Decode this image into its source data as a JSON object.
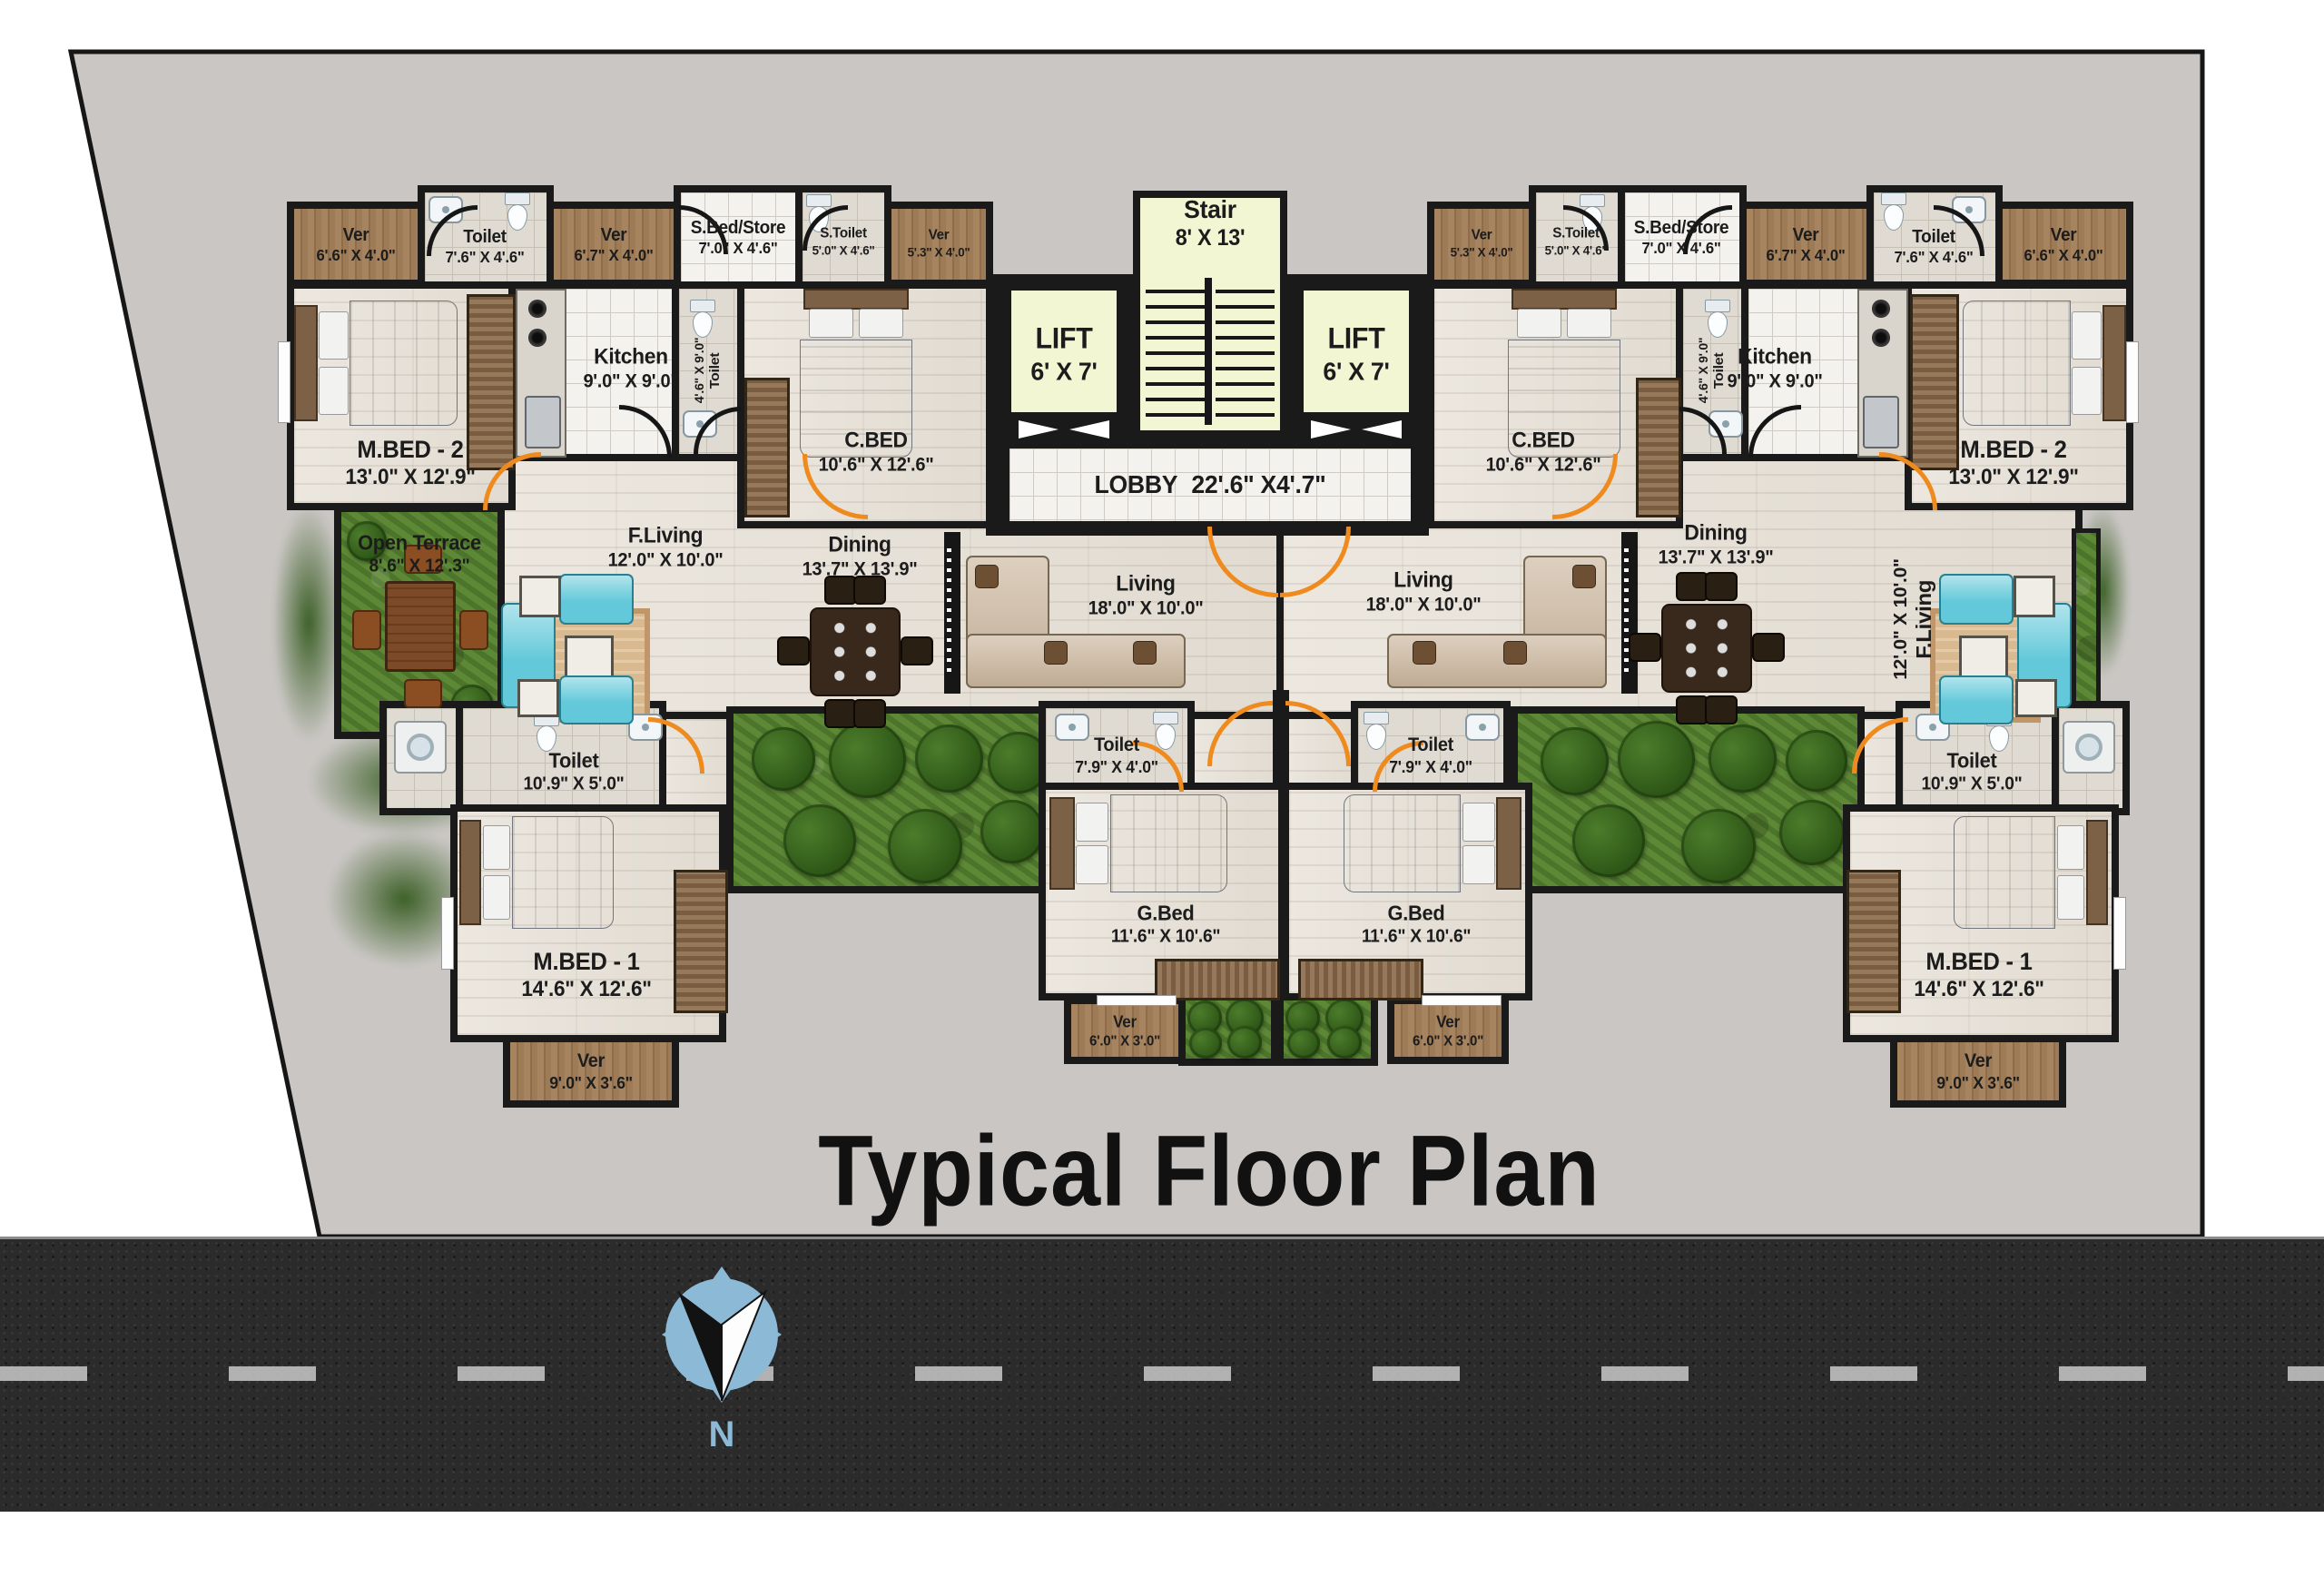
{
  "title": "Typical Floor Plan",
  "compass": {
    "label": "N"
  },
  "core": {
    "stair": {
      "label": "Stair",
      "dims": "8' X 13'"
    },
    "lift_left": {
      "label": "LIFT",
      "dims": "6' X 7'"
    },
    "lift_right": {
      "label": "LIFT",
      "dims": "6' X 7'"
    },
    "lobby": {
      "label": "LOBBY",
      "dims": "22'.6\" X4'.7\""
    }
  },
  "left_unit": {
    "ver_top_1": {
      "label": "Ver",
      "dims": "6'.6\" X 4'.0\""
    },
    "toilet_top": {
      "label": "Toilet",
      "dims": "7'.6\" X 4'.6\""
    },
    "ver_top_2": {
      "label": "Ver",
      "dims": "6'.7\" X 4'.0\""
    },
    "sbed_store": {
      "label": "S.Bed/Store",
      "dims": "7'.0\" X 4'.6\""
    },
    "s_toilet": {
      "label": "S.Toilet",
      "dims": "5'.0\" X 4'.6\""
    },
    "ver_top_3": {
      "label": "Ver",
      "dims": "5'.3\" X 4'.0\""
    },
    "mbed2": {
      "label": "M.BED - 2",
      "dims": "13'.0\" X 12'.9\""
    },
    "kitchen": {
      "label": "Kitchen",
      "dims": "9'.0\" X 9'.0\""
    },
    "toilet_kitchen": {
      "label": "Toilet",
      "dims": "4'.6\" X 9'.0\""
    },
    "cbed": {
      "label": "C.BED",
      "dims": "10'.6\" X 12'.6\""
    },
    "open_terrace": {
      "label": "Open Terrace",
      "dims": "8'.6\" X 12'.3\""
    },
    "f_living": {
      "label": "F.Living",
      "dims": "12'.0\" X 10'.0\""
    },
    "dining": {
      "label": "Dining",
      "dims": "13'.7\" X 13'.9\""
    },
    "living": {
      "label": "Living",
      "dims": "18'.0\" X 10'.0\""
    },
    "toilet_mid": {
      "label": "Toilet",
      "dims": "7'.9\" X 4'.0\""
    },
    "toilet_low": {
      "label": "Toilet",
      "dims": "10'.9\" X 5'.0\""
    },
    "gbed": {
      "label": "G.Bed",
      "dims": "11'.6\" X 10'.6\""
    },
    "ver_small": {
      "label": "Ver",
      "dims": "6'.0\" X 3'.0\""
    },
    "mbed1": {
      "label": "M.BED - 1",
      "dims": "14'.6\" X 12'.6\""
    },
    "ver_bottom": {
      "label": "Ver",
      "dims": "9'.0\" X 3'.6\""
    }
  },
  "right_unit": {
    "ver_top_1": {
      "label": "Ver",
      "dims": "6'.6\" X 4'.0\""
    },
    "toilet_top": {
      "label": "Toilet",
      "dims": "7'.6\" X 4'.6\""
    },
    "ver_top_2": {
      "label": "Ver",
      "dims": "6'.7\" X 4'.0\""
    },
    "sbed_store": {
      "label": "S.Bed/Store",
      "dims": "7'.0\" X 4'.6\""
    },
    "s_toilet": {
      "label": "S.Toilet",
      "dims": "5'.0\" X 4'.6\""
    },
    "ver_top_3": {
      "label": "Ver",
      "dims": "5'.3\" X 4'.0\""
    },
    "mbed2": {
      "label": "M.BED - 2",
      "dims": "13'.0\" X 12'.9\""
    },
    "kitchen": {
      "label": "Kitchen",
      "dims": "9'.0\" X 9'.0\""
    },
    "toilet_kitchen": {
      "label": "Toilet",
      "dims": "4'.6\" X 9'.0\""
    },
    "cbed": {
      "label": "C.BED",
      "dims": "10'.6\" X 12'.6\""
    },
    "f_living": {
      "label": "F.Living",
      "dims": "12'.0\" X 10'.0\""
    },
    "dining": {
      "label": "Dining",
      "dims": "13'.7\" X 13'.9\""
    },
    "living": {
      "label": "Living",
      "dims": "18'.0\" X 10'.0\""
    },
    "toilet_mid": {
      "label": "Toilet",
      "dims": "7'.9\" X 4'.0\""
    },
    "toilet_low": {
      "label": "Toilet",
      "dims": "10'.9\" X 5'.0\""
    },
    "gbed": {
      "label": "G.Bed",
      "dims": "11'.6\" X 10'.6\""
    },
    "ver_small": {
      "label": "Ver",
      "dims": "6'.0\" X 3'.0\""
    },
    "mbed1": {
      "label": "M.BED - 1",
      "dims": "14'.6\" X 12'.6\""
    },
    "ver_bottom": {
      "label": "Ver",
      "dims": "9'.0\" X 3'.6\""
    }
  },
  "colors": {
    "wall": "#1a1a1a",
    "plot": "#c9c6c3",
    "door": "#ef8b1e",
    "lift_stair": "#f3f6d3",
    "grass": "#5d8836",
    "veranda_wood": "#9c7a55",
    "floor_wood": "#e9e4dc",
    "road": "#2b2b2b",
    "compass_blue": "#8cb9d6"
  }
}
